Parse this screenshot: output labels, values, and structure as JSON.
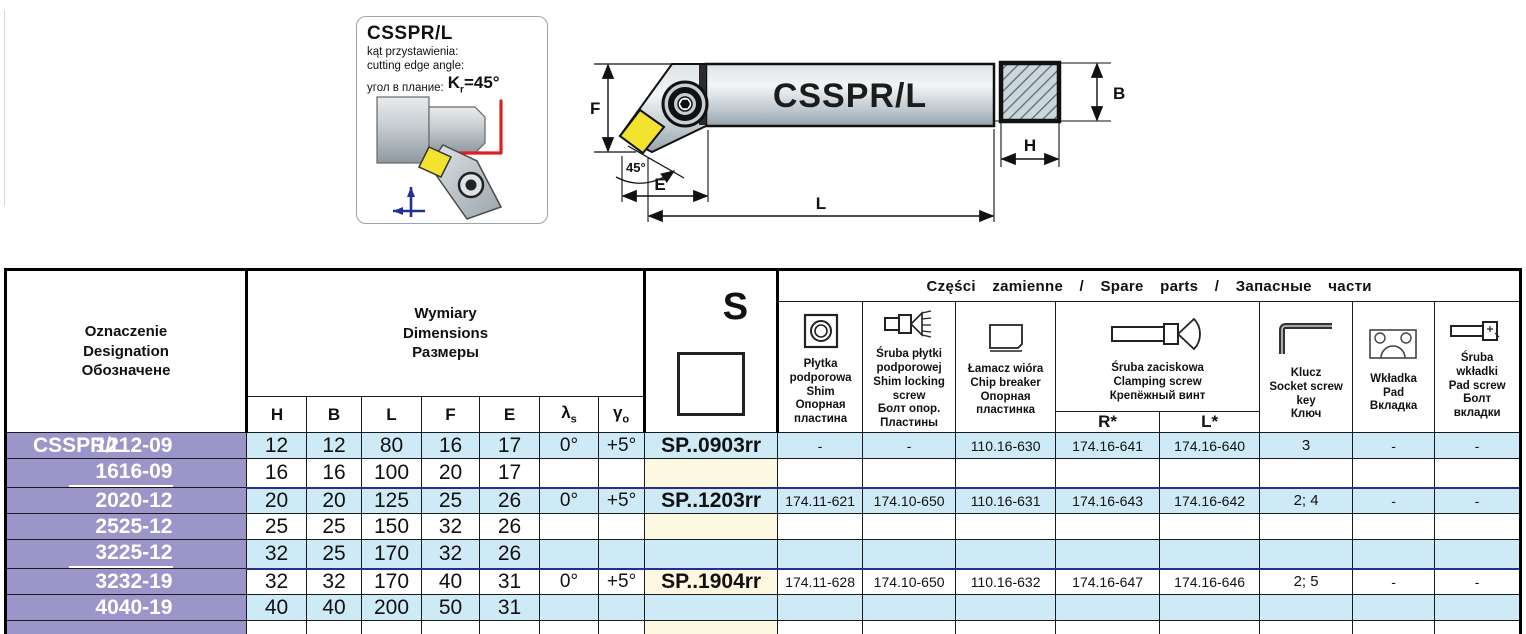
{
  "info_box": {
    "title": "CSSPR/L",
    "lines": [
      "kąt przystawienia:",
      "cutting edge angle:",
      "угол в плание:"
    ],
    "angle": {
      "k": "K",
      "sub": "r",
      "val": "=45°"
    }
  },
  "drawing": {
    "body_label": "CSSPR/L",
    "dim_f": "F",
    "dim_e": "E",
    "dim_l": "L",
    "angle_label": "45°",
    "dim_b": "B",
    "dim_h": "H"
  },
  "colors": {
    "purple": "#9b95c9",
    "row_blue": "#cfeaf7",
    "row_cream": "#fdf8e1",
    "row_white": "#ffffff",
    "navy": "#2c2c8c",
    "insert_yellow": "#f3e32e"
  },
  "table": {
    "designation_header": "Oznaczenie\nDesignation\nОбозначене",
    "dimensions_header": "Wymiary\nDimensions\nРазмеры",
    "dim_cols": [
      "H",
      "B",
      "L",
      "F",
      "E"
    ],
    "lambda": {
      "sym": "λ",
      "sub": "s"
    },
    "gamma": {
      "sym": "γ",
      "sub": "o"
    },
    "s_col": "S",
    "spare_title": "Części zamienne / Spare parts / Запасные части",
    "r_star": "R*",
    "l_star": "L*",
    "spare_cols": [
      {
        "icon": "shim-icon",
        "label": "Płytka\npodporowa\nShim\nОпорная\nпластина"
      },
      {
        "icon": "shim-locking-screw-icon",
        "label": "Śruba płytki\npodporowej\nShim locking\nscrew\nБолт опор.\nПластины"
      },
      {
        "icon": "chip-breaker-icon",
        "label": "Łamacz wióra\nChip breaker\nОпорная\nпластинка"
      },
      {
        "icon": "clamping-screw-icon",
        "label": "Śruba zaciskowa\nClamping screw\nКрепёжный винт"
      },
      {
        "icon": "socket-screw-key-icon",
        "label": "Klucz\nSocket screw\nkey\nКлюч"
      },
      {
        "icon": "pad-icon",
        "label": "Wkładka\nPad\nВкладка"
      },
      {
        "icon": "pad-screw-icon",
        "label": "Śruba\nwkładki\nPad screw\nБолт\nвкладки"
      }
    ],
    "rows": [
      {
        "brand": "CSSPR/L",
        "designation": "1212-09",
        "h": "12",
        "b": "12",
        "l": "80",
        "f": "16",
        "e": "17",
        "ls": "0°",
        "go": "+5°",
        "s": "SP..0903rr",
        "shim": "-",
        "shim_screw": "-",
        "chip_breaker": "110.16-630",
        "clamp_r": "174.16-641",
        "clamp_l": "174.16-640",
        "key": "3",
        "pad": "-",
        "pad_screw": "-",
        "group_start": false,
        "sep_after": false
      },
      {
        "brand": "",
        "designation": "1616-09",
        "h": "16",
        "b": "16",
        "l": "100",
        "f": "20",
        "e": "17",
        "ls": "",
        "go": "",
        "s": "",
        "shim": "",
        "shim_screw": "",
        "chip_breaker": "",
        "clamp_r": "",
        "clamp_l": "",
        "key": "",
        "pad": "",
        "pad_screw": "",
        "group_start": false,
        "sep_after": true
      },
      {
        "brand": "",
        "designation": "2020-12",
        "h": "20",
        "b": "20",
        "l": "125",
        "f": "25",
        "e": "26",
        "ls": "0°",
        "go": "+5°",
        "s": "SP..1203rr",
        "shim": "174.11-621",
        "shim_screw": "174.10-650",
        "chip_breaker": "110.16-631",
        "clamp_r": "174.16-643",
        "clamp_l": "174.16-642",
        "key": "2; 4",
        "pad": "-",
        "pad_screw": "-",
        "group_start": true,
        "sep_after": false
      },
      {
        "brand": "",
        "designation": "2525-12",
        "h": "25",
        "b": "25",
        "l": "150",
        "f": "32",
        "e": "26",
        "ls": "",
        "go": "",
        "s": "",
        "shim": "",
        "shim_screw": "",
        "chip_breaker": "",
        "clamp_r": "",
        "clamp_l": "",
        "key": "",
        "pad": "",
        "pad_screw": "",
        "group_start": false,
        "sep_after": false
      },
      {
        "brand": "",
        "designation": "3225-12",
        "h": "32",
        "b": "25",
        "l": "170",
        "f": "32",
        "e": "26",
        "ls": "",
        "go": "",
        "s": "",
        "shim": "",
        "shim_screw": "",
        "chip_breaker": "",
        "clamp_r": "",
        "clamp_l": "",
        "key": "",
        "pad": "",
        "pad_screw": "",
        "group_start": false,
        "sep_after": true
      },
      {
        "brand": "",
        "designation": "3232-19",
        "h": "32",
        "b": "32",
        "l": "170",
        "f": "40",
        "e": "31",
        "ls": "0°",
        "go": "+5°",
        "s": "SP..1904rr",
        "shim": "174.11-628",
        "shim_screw": "174.10-650",
        "chip_breaker": "110.16-632",
        "clamp_r": "174.16-647",
        "clamp_l": "174.16-646",
        "key": "2; 5",
        "pad": "-",
        "pad_screw": "-",
        "group_start": true,
        "sep_after": false
      },
      {
        "brand": "",
        "designation": "4040-19",
        "h": "40",
        "b": "40",
        "l": "200",
        "f": "50",
        "e": "31",
        "ls": "",
        "go": "",
        "s": "",
        "shim": "",
        "shim_screw": "",
        "chip_breaker": "",
        "clamp_r": "",
        "clamp_l": "",
        "key": "",
        "pad": "",
        "pad_screw": "",
        "group_start": false,
        "sep_after": false
      },
      {
        "brand": "",
        "designation": "",
        "h": "",
        "b": "",
        "l": "",
        "f": "",
        "e": "",
        "ls": "",
        "go": "",
        "s": "",
        "shim": "",
        "shim_screw": "",
        "chip_breaker": "",
        "clamp_r": "",
        "clamp_l": "",
        "key": "",
        "pad": "",
        "pad_screw": "",
        "group_start": false,
        "sep_after": false
      }
    ]
  }
}
